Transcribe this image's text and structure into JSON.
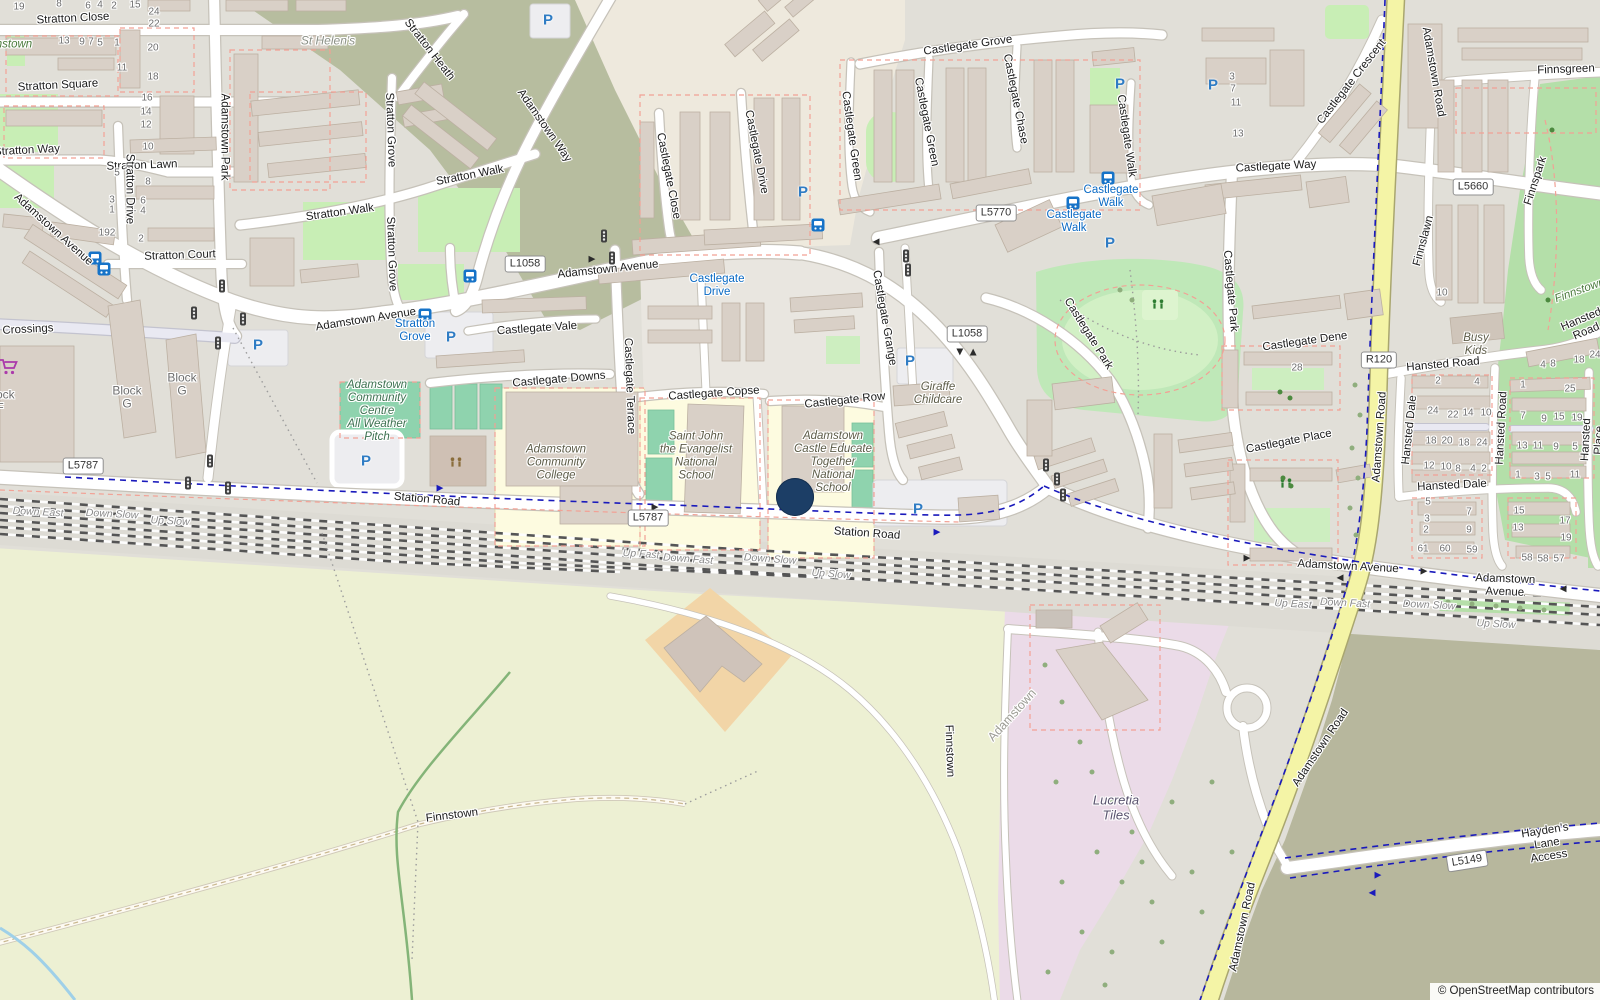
{
  "attribution": "© OpenStreetMap contributors",
  "marker": {
    "x": 795,
    "y": 497,
    "d": 38,
    "color": "#1c3e66"
  },
  "labels": [
    [
      "Stratton Close",
      73,
      19,
      -3,
      "s"
    ],
    [
      "Stratton Square",
      58,
      86,
      -3,
      "s"
    ],
    [
      "Stratton Way",
      27,
      151,
      -3,
      "s"
    ],
    [
      "Stratton Lawn",
      142,
      166,
      -2,
      "s"
    ],
    [
      "Stratton Court",
      180,
      256,
      -2,
      "s"
    ],
    [
      "Stratton Drive",
      129,
      189,
      90,
      "s"
    ],
    [
      "Adamstown Park",
      224,
      137,
      90,
      "s"
    ],
    [
      "Stratton Walk",
      340,
      213,
      -8,
      "s"
    ],
    [
      "Stratton Walk",
      470,
      176,
      -11,
      "s"
    ],
    [
      "Stratton Grove",
      390,
      130,
      88,
      "s"
    ],
    [
      "Stratton Grove",
      391,
      254,
      88,
      "s"
    ],
    [
      "Stratton Heath",
      429,
      50,
      52,
      "s"
    ],
    [
      "Adamstown Way",
      544,
      126,
      55,
      "s"
    ],
    [
      "Adamstown Avenue",
      53,
      230,
      42,
      "s"
    ],
    [
      "Adamstown Avenue",
      366,
      320,
      -9,
      "s"
    ],
    [
      "Adamstown Avenue",
      608,
      270,
      -6,
      "s"
    ],
    [
      "Adamstown Avenue",
      1348,
      567,
      3,
      "s"
    ],
    [
      "Adamstown Avenue",
      1505,
      586,
      2,
      "s"
    ],
    [
      "Castlegate Close",
      668,
      176,
      79,
      "s"
    ],
    [
      "Castlegate Drive",
      756,
      152,
      79,
      "s"
    ],
    [
      "Castlegate Grove",
      968,
      46,
      -8,
      "s"
    ],
    [
      "Castlegate Green",
      851,
      136,
      82,
      "s"
    ],
    [
      "Castlegate Green",
      926,
      122,
      79,
      "s"
    ],
    [
      "Castlegate Chase",
      1015,
      99,
      79,
      "s"
    ],
    [
      "Castlegate Walk",
      1126,
      136,
      82,
      "s"
    ],
    [
      "Castlegate Way",
      1276,
      167,
      -3,
      "s"
    ],
    [
      "Castlegate Crescent",
      1352,
      82,
      -52,
      "s"
    ],
    [
      "Castlegate Vale",
      537,
      329,
      -4,
      "s"
    ],
    [
      "Castlegate Downs",
      559,
      380,
      -5,
      "s"
    ],
    [
      "Castlegate Copse",
      714,
      394,
      -4,
      "s"
    ],
    [
      "Castlegate Row",
      845,
      401,
      -6,
      "s"
    ],
    [
      "Castlegate Terrace",
      629,
      386,
      88,
      "s"
    ],
    [
      "Castlegate Grange",
      884,
      318,
      80,
      "s"
    ],
    [
      "Castlegate Park",
      1088,
      334,
      58,
      "s"
    ],
    [
      "Castlegate Park",
      1230,
      291,
      85,
      "s"
    ],
    [
      "Castlegate Dene",
      1305,
      342,
      -8,
      "s"
    ],
    [
      "Castlegate Place",
      1289,
      442,
      -11,
      "s"
    ],
    [
      "Station Road",
      427,
      500,
      5,
      "s"
    ],
    [
      "Station Road",
      867,
      534,
      4,
      "s"
    ],
    [
      "Finnsgreen",
      1566,
      70,
      -2,
      "s"
    ],
    [
      "Finnslawn",
      1424,
      241,
      -75,
      "s"
    ],
    [
      "Finnspark",
      1536,
      181,
      -72,
      "s"
    ],
    [
      "Adamstown Road",
      1433,
      72,
      80,
      "s"
    ],
    [
      "Adamstown Road",
      1380,
      437,
      -86,
      "s"
    ],
    [
      "Adamstown Road",
      1321,
      748,
      -56,
      "s"
    ],
    [
      "Adamstown Road",
      1243,
      927,
      -78,
      "s"
    ],
    [
      "Hansted Road",
      1443,
      365,
      -5,
      "s"
    ],
    [
      "Hansted Road",
      1502,
      428,
      -87,
      "s"
    ],
    [
      "Hansted Place",
      1593,
      440,
      -87,
      "s"
    ],
    [
      "Hansted Dale",
      1410,
      430,
      -84,
      "s"
    ],
    [
      "Hansted Dale",
      1452,
      486,
      -3,
      "s"
    ],
    [
      "Hansted Road",
      1584,
      326,
      -23,
      "s"
    ],
    [
      "Hayden's Lane Access",
      1547,
      844,
      -9,
      "s"
    ],
    [
      "Crossings",
      28,
      330,
      -3,
      "s"
    ],
    [
      "Finnstown",
      452,
      816,
      -7,
      "s"
    ],
    [
      "Finnstown",
      949,
      751,
      88,
      "s"
    ],
    [
      "Stratton\nGrove",
      415,
      331,
      0,
      "b"
    ],
    [
      "Castlegate\nDrive",
      717,
      286,
      0,
      "b"
    ],
    [
      "Castlegate\nWalk",
      1111,
      197,
      0,
      "b"
    ],
    [
      "Castlegate\nWalk",
      1074,
      222,
      0,
      "b"
    ],
    [
      "Adamstown\nCommunity\nCentre\nAll Weather\nPitch",
      377,
      411,
      0,
      "pg"
    ],
    [
      "Adamstown\nCommunity\nCollege",
      556,
      463,
      0,
      "p"
    ],
    [
      "Saint John\nthe Evangelist\nNational\nSchool",
      696,
      456,
      0,
      "p"
    ],
    [
      "Adamstown\nCastle Educate\nTogether\nNational\nSchool",
      833,
      462,
      0,
      "p"
    ],
    [
      "Giraffe\nChildcare",
      938,
      394,
      0,
      "p"
    ],
    [
      "Busy\nKids",
      1476,
      345,
      0,
      "p"
    ],
    [
      "Lucretia\nTiles",
      1116,
      808,
      0,
      "i"
    ],
    [
      "Block\nG",
      127,
      398,
      0,
      "bl"
    ],
    [
      "Block\nG",
      182,
      385,
      0,
      "bl"
    ],
    [
      "Block\nF",
      0,
      402,
      0,
      "bl"
    ],
    [
      "St Helen's",
      328,
      41,
      0,
      "gi"
    ],
    [
      "Finnstown",
      6,
      45,
      0,
      "g"
    ],
    [
      "Finnstown",
      1580,
      291,
      -20,
      "g"
    ],
    [
      "Adamstown",
      1012,
      715,
      -48,
      "pl"
    ],
    [
      "Down East",
      38,
      513,
      3,
      "r"
    ],
    [
      "Down Slow",
      112,
      515,
      3,
      "r"
    ],
    [
      "Up Slow",
      170,
      522,
      3,
      "r"
    ],
    [
      "Up Fast",
      641,
      555,
      4,
      "r"
    ],
    [
      "Down Fast",
      688,
      560,
      4,
      "r"
    ],
    [
      "Down Slow",
      770,
      560,
      4,
      "r"
    ],
    [
      "Up Slow",
      831,
      575,
      4,
      "r"
    ],
    [
      "Up East",
      1293,
      605,
      3,
      "r"
    ],
    [
      "Down Fast",
      1345,
      604,
      3,
      "r"
    ],
    [
      "Down Slow",
      1429,
      606,
      3,
      "r"
    ],
    [
      "Up Slow",
      1496,
      625,
      3,
      "r"
    ],
    [
      "19",
      19,
      7,
      0,
      "n"
    ],
    [
      "8",
      59,
      4,
      0,
      "n"
    ],
    [
      "6",
      88,
      6,
      0,
      "n"
    ],
    [
      "4",
      100,
      5,
      0,
      "n"
    ],
    [
      "2",
      114,
      6,
      0,
      "n"
    ],
    [
      "15",
      135,
      5,
      0,
      "n"
    ],
    [
      "24",
      154,
      12,
      0,
      "n"
    ],
    [
      "22",
      154,
      24,
      0,
      "n"
    ],
    [
      "20",
      153,
      48,
      0,
      "n"
    ],
    [
      "13",
      64,
      41,
      0,
      "n"
    ],
    [
      "9",
      82,
      42,
      0,
      "n"
    ],
    [
      "7",
      91,
      42,
      0,
      "n"
    ],
    [
      "5",
      100,
      43,
      0,
      "n"
    ],
    [
      "1",
      117,
      43,
      0,
      "n"
    ],
    [
      "11",
      122,
      68,
      0,
      "n"
    ],
    [
      "18",
      153,
      77,
      0,
      "n"
    ],
    [
      "16",
      147,
      98,
      0,
      "n"
    ],
    [
      "14",
      146,
      112,
      0,
      "n"
    ],
    [
      "12",
      146,
      125,
      0,
      "n"
    ],
    [
      "10",
      148,
      147,
      0,
      "n"
    ],
    [
      "5",
      117,
      173,
      0,
      "n"
    ],
    [
      "8",
      148,
      182,
      0,
      "n"
    ],
    [
      "3",
      112,
      200,
      0,
      "n"
    ],
    [
      "1",
      112,
      210,
      0,
      "n"
    ],
    [
      "6",
      143,
      201,
      0,
      "n"
    ],
    [
      "4",
      143,
      211,
      0,
      "n"
    ],
    [
      "2",
      141,
      239,
      0,
      "n"
    ],
    [
      "192",
      107,
      233,
      0,
      "n"
    ],
    [
      "3",
      1232,
      77,
      0,
      "n"
    ],
    [
      "7",
      1233,
      89,
      0,
      "n"
    ],
    [
      "11",
      1236,
      103,
      0,
      "n"
    ],
    [
      "13",
      1238,
      134,
      0,
      "n"
    ],
    [
      "10",
      1442,
      293,
      0,
      "n"
    ],
    [
      "28",
      1297,
      368,
      0,
      "n"
    ],
    [
      "2",
      1438,
      381,
      0,
      "n"
    ],
    [
      "4",
      1477,
      382,
      0,
      "n"
    ],
    [
      "24",
      1433,
      411,
      0,
      "n"
    ],
    [
      "22",
      1453,
      415,
      0,
      "n"
    ],
    [
      "14",
      1468,
      413,
      0,
      "n"
    ],
    [
      "10",
      1486,
      413,
      0,
      "n"
    ],
    [
      "18",
      1431,
      441,
      0,
      "n"
    ],
    [
      "20",
      1447,
      441,
      0,
      "n"
    ],
    [
      "18",
      1464,
      443,
      0,
      "n"
    ],
    [
      "24",
      1482,
      443,
      0,
      "n"
    ],
    [
      "12",
      1429,
      466,
      0,
      "n"
    ],
    [
      "10",
      1446,
      467,
      0,
      "n"
    ],
    [
      "8",
      1458,
      469,
      0,
      "n"
    ],
    [
      "4",
      1473,
      469,
      0,
      "n"
    ],
    [
      "2",
      1484,
      469,
      0,
      "n"
    ],
    [
      "5",
      1428,
      502,
      0,
      "n"
    ],
    [
      "3",
      1427,
      519,
      0,
      "n"
    ],
    [
      "2",
      1426,
      530,
      0,
      "n"
    ],
    [
      "7",
      1469,
      512,
      0,
      "n"
    ],
    [
      "9",
      1469,
      530,
      0,
      "n"
    ],
    [
      "61",
      1423,
      549,
      0,
      "n"
    ],
    [
      "60",
      1445,
      549,
      0,
      "n"
    ],
    [
      "59",
      1472,
      550,
      0,
      "n"
    ],
    [
      "1",
      1523,
      385,
      0,
      "n"
    ],
    [
      "25",
      1570,
      389,
      0,
      "n"
    ],
    [
      "7",
      1523,
      416,
      0,
      "n"
    ],
    [
      "9",
      1544,
      419,
      0,
      "n"
    ],
    [
      "15",
      1559,
      417,
      0,
      "n"
    ],
    [
      "19",
      1577,
      418,
      0,
      "n"
    ],
    [
      "13",
      1522,
      446,
      0,
      "n"
    ],
    [
      "11",
      1538,
      446,
      0,
      "n"
    ],
    [
      "9",
      1556,
      447,
      0,
      "n"
    ],
    [
      "5",
      1575,
      447,
      0,
      "n"
    ],
    [
      "1",
      1518,
      475,
      0,
      "n"
    ],
    [
      "3",
      1537,
      477,
      0,
      "n"
    ],
    [
      "5",
      1548,
      477,
      0,
      "n"
    ],
    [
      "11",
      1575,
      475,
      0,
      "n"
    ],
    [
      "15",
      1519,
      511,
      0,
      "n"
    ],
    [
      "13",
      1518,
      528,
      0,
      "n"
    ],
    [
      "17",
      1565,
      521,
      0,
      "n"
    ],
    [
      "19",
      1566,
      538,
      0,
      "n"
    ],
    [
      "58",
      1527,
      558,
      0,
      "n"
    ],
    [
      "58",
      1543,
      559,
      0,
      "n"
    ],
    [
      "57",
      1559,
      559,
      0,
      "n"
    ],
    [
      "4",
      1543,
      365,
      0,
      "n"
    ],
    [
      "8",
      1553,
      364,
      0,
      "n"
    ],
    [
      "18",
      1579,
      360,
      0,
      "n"
    ],
    [
      "24",
      1595,
      355,
      0,
      "n"
    ]
  ],
  "badges": [
    [
      "L1058",
      525,
      264,
      0
    ],
    [
      "L1058",
      967,
      334,
      0
    ],
    [
      "L5770",
      996,
      213,
      0
    ],
    [
      "L5787",
      83,
      466,
      0
    ],
    [
      "L5787",
      648,
      518,
      0
    ],
    [
      "R120",
      1379,
      360,
      0
    ],
    [
      "L5660",
      1473,
      187,
      0
    ],
    [
      "L5149",
      1467,
      861,
      -9
    ]
  ],
  "icons": {
    "parking": [
      [
        548,
        20
      ],
      [
        1120,
        84
      ],
      [
        1213,
        85
      ],
      [
        803,
        192
      ],
      [
        1110,
        243
      ],
      [
        258,
        345
      ],
      [
        451,
        337
      ],
      [
        366,
        461
      ],
      [
        910,
        361
      ],
      [
        918,
        509
      ]
    ],
    "bus": [
      [
        425,
        315
      ],
      [
        470,
        276
      ],
      [
        818,
        225
      ],
      [
        1108,
        178
      ],
      [
        1073,
        203
      ],
      [
        95,
        258
      ],
      [
        104,
        269
      ]
    ],
    "signal": [
      [
        222,
        286
      ],
      [
        194,
        313
      ],
      [
        243,
        319
      ],
      [
        218,
        343
      ],
      [
        210,
        461
      ],
      [
        188,
        483
      ],
      [
        228,
        488
      ],
      [
        604,
        236
      ],
      [
        612,
        258
      ],
      [
        906,
        256
      ],
      [
        908,
        270
      ],
      [
        1046,
        465
      ],
      [
        1057,
        479
      ],
      [
        1063,
        495
      ]
    ],
    "playground": [
      [
        456,
        463,
        "#8a6d3b"
      ],
      [
        1158,
        305,
        "#2e7d32"
      ],
      [
        1286,
        484,
        "#2e7d32"
      ]
    ],
    "supermarket": [
      [
        9,
        367
      ]
    ],
    "arrows": [
      [
        592,
        259,
        0,
        "d"
      ],
      [
        876,
        242,
        180,
        "d"
      ],
      [
        655,
        507,
        0,
        "d"
      ],
      [
        1247,
        558,
        0,
        "d"
      ],
      [
        1424,
        571,
        0,
        "d"
      ],
      [
        1340,
        578,
        180,
        "d"
      ],
      [
        1563,
        589,
        180,
        "d"
      ],
      [
        960,
        352,
        90,
        "d"
      ],
      [
        973,
        352,
        -90,
        "d"
      ],
      [
        440,
        488,
        0,
        "bl"
      ],
      [
        937,
        532,
        0,
        "bl"
      ],
      [
        1378,
        875,
        0,
        "bl"
      ],
      [
        1372,
        893,
        180,
        "bl"
      ]
    ],
    "trees_light": [
      [
        1355,
        385
      ],
      [
        1360,
        415
      ],
      [
        1352,
        448
      ],
      [
        1358,
        478
      ],
      [
        1350,
        508
      ],
      [
        1356,
        535
      ],
      [
        1120,
        290
      ],
      [
        1132,
        300
      ],
      [
        1448,
        602
      ],
      [
        1472,
        604
      ],
      [
        1496,
        606
      ],
      [
        1520,
        608
      ],
      [
        1544,
        610
      ],
      [
        1045,
        665
      ],
      [
        1062,
        702
      ],
      [
        1080,
        742
      ],
      [
        1056,
        782
      ],
      [
        1092,
        772
      ],
      [
        1112,
        802
      ],
      [
        1132,
        832
      ],
      [
        1097,
        852
      ],
      [
        1062,
        882
      ],
      [
        1122,
        882
      ],
      [
        1152,
        902
      ],
      [
        1082,
        932
      ],
      [
        1112,
        952
      ],
      [
        1162,
        942
      ],
      [
        1192,
        872
      ],
      [
        1202,
        912
      ],
      [
        1172,
        802
      ],
      [
        1212,
        782
      ],
      [
        1232,
        852
      ],
      [
        1142,
        862
      ],
      [
        1048,
        972
      ],
      [
        1105,
        985
      ]
    ],
    "trees_dark": [
      [
        1283,
        478
      ],
      [
        1291,
        486
      ],
      [
        1280,
        392
      ],
      [
        1290,
        398
      ],
      [
        1552,
        130
      ],
      [
        1548,
        300
      ]
    ]
  },
  "colors": {
    "residential": "#e1dfd8",
    "farmland": "#edf0d3",
    "industrial": "#ebdbe8",
    "brownfield": "#b7b79d",
    "scrub_olive": "#b7bd9f",
    "park": "#bfe8b8",
    "grass": "#c8eeb5",
    "pitch": "#8fd3ae",
    "school": "#fdfbe0",
    "road_secondary": "#f4f4a6",
    "cycleway_dash": "#1a1abc",
    "boundary_dash": "#f2a195",
    "marker": "#1c3e66"
  }
}
